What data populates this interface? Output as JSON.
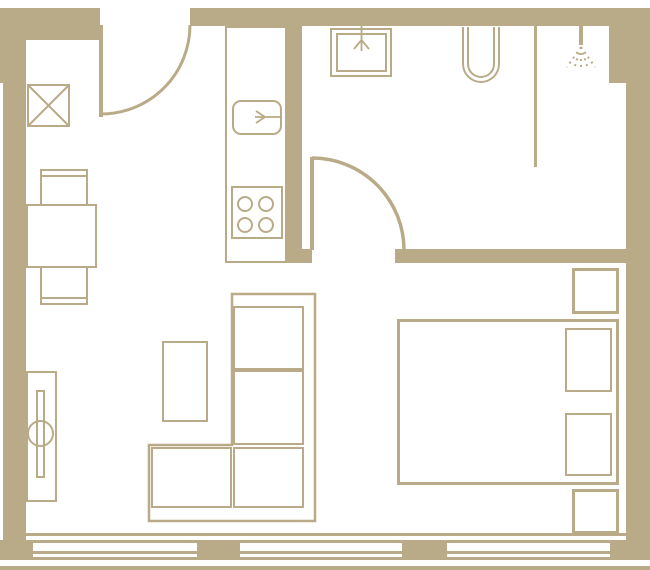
{
  "canvas": {
    "width": 650,
    "height": 570,
    "background": "#ffffff",
    "ink": "#b9ab87"
  },
  "plan": {
    "kind": "apartment-floor-plan",
    "walls": [
      {
        "name": "top-wall-left",
        "x": 0,
        "y": 8,
        "w": 100,
        "h": 32
      },
      {
        "name": "top-wall-right",
        "x": 190,
        "y": 8,
        "w": 460,
        "h": 18
      },
      {
        "name": "left-wall-upper",
        "x": 0,
        "y": 40,
        "w": 26,
        "h": 43
      },
      {
        "name": "left-wall",
        "x": 3,
        "y": 83,
        "w": 23,
        "h": 457
      },
      {
        "name": "bottom-left-corner",
        "x": 0,
        "y": 540,
        "w": 33,
        "h": 20
      },
      {
        "name": "right-wall",
        "x": 626,
        "y": 26,
        "w": 24,
        "h": 534
      },
      {
        "name": "shower-duct",
        "x": 609,
        "y": 26,
        "w": 17,
        "h": 57
      },
      {
        "name": "kitchen-bath-wall",
        "x": 287,
        "y": 26,
        "w": 15,
        "h": 237
      },
      {
        "name": "bath-bottom-wall-left",
        "x": 287,
        "y": 249,
        "w": 25,
        "h": 14
      },
      {
        "name": "bath-bottom-wall-right",
        "x": 395,
        "y": 249,
        "w": 255,
        "h": 14
      },
      {
        "name": "window-pier-1",
        "x": 197,
        "y": 540,
        "w": 43,
        "h": 20
      },
      {
        "name": "window-pier-2",
        "x": 402,
        "y": 540,
        "w": 45,
        "h": 20
      },
      {
        "name": "window-pier-3",
        "x": 610,
        "y": 540,
        "w": 40,
        "h": 20
      },
      {
        "name": "interior-face-line",
        "x": 26,
        "y": 533,
        "w": 600,
        "h": 3
      },
      {
        "name": "bottom-terrace-line",
        "x": 0,
        "y": 566,
        "w": 650,
        "h": 4
      },
      {
        "name": "entry-door-leaf",
        "x": 99,
        "y": 25,
        "w": 4,
        "h": 92
      },
      {
        "name": "bath-door-leaf",
        "x": 310,
        "y": 157,
        "w": 4,
        "h": 93
      },
      {
        "name": "shower-partition",
        "x": 534,
        "y": 26,
        "w": 3,
        "h": 141
      },
      {
        "name": "shower-head-stem",
        "x": 579,
        "y": 26,
        "w": 4,
        "h": 19
      },
      {
        "name": "window-1-line-top",
        "x": 33,
        "y": 540,
        "w": 164,
        "h": 3
      },
      {
        "name": "window-1-line-mid",
        "x": 33,
        "y": 551,
        "w": 164,
        "h": 3
      },
      {
        "name": "window-1-line-bottom",
        "x": 33,
        "y": 557,
        "w": 164,
        "h": 3
      },
      {
        "name": "window-2-line-top",
        "x": 240,
        "y": 540,
        "w": 162,
        "h": 3
      },
      {
        "name": "window-2-line-mid",
        "x": 240,
        "y": 551,
        "w": 162,
        "h": 3
      },
      {
        "name": "window-2-line-bottom",
        "x": 240,
        "y": 557,
        "w": 162,
        "h": 3
      },
      {
        "name": "window-3-line-top",
        "x": 447,
        "y": 540,
        "w": 163,
        "h": 3
      },
      {
        "name": "window-3-line-mid",
        "x": 447,
        "y": 551,
        "w": 163,
        "h": 3
      },
      {
        "name": "window-3-line-bottom",
        "x": 447,
        "y": 557,
        "w": 163,
        "h": 3
      }
    ],
    "boxes": [
      {
        "name": "vent-shaft",
        "x": 27,
        "y": 84,
        "w": 43,
        "h": 43
      },
      {
        "name": "kitchen-counter",
        "x": 225,
        "y": 26,
        "w": 62,
        "h": 237
      },
      {
        "name": "kitchen-sink",
        "x": 232,
        "y": 100,
        "w": 50,
        "h": 35,
        "css": "border-radius:9px"
      },
      {
        "name": "stove",
        "x": 231,
        "y": 186,
        "w": 52,
        "h": 53
      },
      {
        "name": "stove-burner-1",
        "x": 237,
        "y": 196,
        "w": 16,
        "h": 16,
        "css": "border-radius:50%"
      },
      {
        "name": "stove-burner-2",
        "x": 258,
        "y": 196,
        "w": 16,
        "h": 16,
        "css": "border-radius:50%"
      },
      {
        "name": "stove-burner-3",
        "x": 237,
        "y": 217,
        "w": 16,
        "h": 16,
        "css": "border-radius:50%"
      },
      {
        "name": "stove-burner-4",
        "x": 258,
        "y": 217,
        "w": 16,
        "h": 16,
        "css": "border-radius:50%"
      },
      {
        "name": "bath-sink-outer",
        "x": 330,
        "y": 28,
        "w": 62,
        "h": 49
      },
      {
        "name": "bath-sink-inner",
        "x": 336,
        "y": 33,
        "w": 51,
        "h": 39
      },
      {
        "name": "toilet-outer",
        "x": 462,
        "y": 27,
        "w": 38,
        "h": 56,
        "css": "border-top:none;border-radius:0 0 19px 19px"
      },
      {
        "name": "toilet-inner",
        "x": 467,
        "y": 27,
        "w": 28,
        "h": 51,
        "css": "border-top:none;border-radius:0 0 14px 14px"
      },
      {
        "name": "dining-table",
        "x": 26,
        "y": 204,
        "w": 71,
        "h": 64
      },
      {
        "name": "dining-chair-top",
        "x": 40,
        "y": 169,
        "w": 48,
        "h": 37
      },
      {
        "name": "dining-chair-top-back",
        "x": 40,
        "y": 169,
        "w": 48,
        "h": 8,
        "css": "background:transparent;border:none;border-bottom:2px solid"
      },
      {
        "name": "dining-chair-bottom",
        "x": 40,
        "y": 266,
        "w": 48,
        "h": 39
      },
      {
        "name": "dining-chair-bottom-back",
        "x": 40,
        "y": 297,
        "w": 48,
        "h": 8,
        "css": "background:transparent;border:none;border-top:2px solid"
      },
      {
        "name": "radiator",
        "x": 26,
        "y": 371,
        "w": 31,
        "h": 131
      },
      {
        "name": "radiator-bar",
        "x": 36,
        "y": 390,
        "w": 9,
        "h": 88
      },
      {
        "name": "radiator-knob",
        "x": 27,
        "y": 420,
        "w": 27,
        "h": 27,
        "css": "background:transparent;border-radius:50%"
      },
      {
        "name": "coffee-table",
        "x": 162,
        "y": 341,
        "w": 46,
        "h": 81
      },
      {
        "name": "sofa-cushion-1",
        "x": 233,
        "y": 306,
        "w": 71,
        "h": 64
      },
      {
        "name": "sofa-cushion-2",
        "x": 233,
        "y": 370,
        "w": 71,
        "h": 75
      },
      {
        "name": "sofa-cushion-corner",
        "x": 233,
        "y": 447,
        "w": 71,
        "h": 61
      },
      {
        "name": "sofa-cushion-left",
        "x": 151,
        "y": 447,
        "w": 81,
        "h": 61
      },
      {
        "name": "bed",
        "x": 397,
        "y": 319,
        "w": 222,
        "h": 166,
        "bw": 3
      },
      {
        "name": "pillow-1",
        "x": 565,
        "y": 328,
        "w": 47,
        "h": 64
      },
      {
        "name": "pillow-2",
        "x": 565,
        "y": 413,
        "w": 47,
        "h": 63
      },
      {
        "name": "nightstand-top",
        "x": 572,
        "y": 268,
        "w": 47,
        "h": 46,
        "bw": 3
      },
      {
        "name": "nightstand-bottom",
        "x": 572,
        "y": 489,
        "w": 47,
        "h": 45,
        "bw": 3
      }
    ],
    "paths": [
      {
        "name": "vent-shaft-cross",
        "d": "M29 86 L68 125 M68 86 L29 125",
        "w": 2
      },
      {
        "name": "entry-door-swing-arc",
        "d": "M190 25 A89 89 0 0 1 101 114",
        "w": 3
      },
      {
        "name": "bath-door-swing-arc",
        "d": "M312 158 A92 92 0 0 1 404 250",
        "w": 3.5
      },
      {
        "name": "sofa-outline",
        "d": "M232 294 L315 294 L315 521 L149 521 L149 445 L232 445 Z",
        "w": 2.5
      },
      {
        "name": "kitchen-faucet",
        "d": "M282 117 L265 117 M265 117 L256 111 M265 117 L255 117 M265 117 L256 123",
        "w": 1.8
      },
      {
        "name": "bath-faucet",
        "d": "M361.5 26 L361.5 40 M361.5 40 L354 49 M361.5 40 L361.5 51 M361.5 40 L369 49",
        "w": 1.8
      },
      {
        "name": "shower-spray",
        "d": "M581 47 L567 67 M581 47 L574 69 M581 47 L581 71 M581 47 L588 69 M581 47 L595 67",
        "w": 2,
        "dash": "2 4"
      }
    ]
  }
}
